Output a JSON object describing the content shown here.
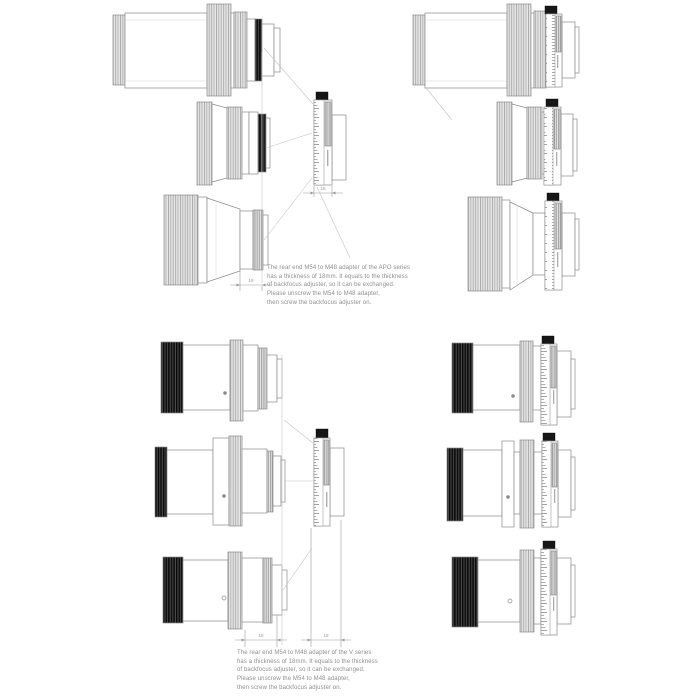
{
  "panels": {
    "apo": {
      "note": "The rear end M54 to M48 adapter of the APO series\nhas a thickness of 18mm. It equals to the thickness\nof backfocus adjuster, so it can be exchanged.\nPlease unscrew the M54 to M48 adapter,\nthen screw the backfocus adjuster on.",
      "dims": {
        "adapter_thickness": "18",
        "adjuster_thickness": "18"
      }
    },
    "v": {
      "note": "The rear end M54 to M48 adapter of the V series\nhas a thickness of 18mm. It equals to the thickness\nof backfocus adjuster, so it can be exchanged.\nPlease unscrew the M54 to M48 adapter,\nthen screw the backfocus adjuster on.",
      "dims": {
        "adapter_thickness": "18",
        "adjuster_thickness": "18"
      }
    }
  }
}
